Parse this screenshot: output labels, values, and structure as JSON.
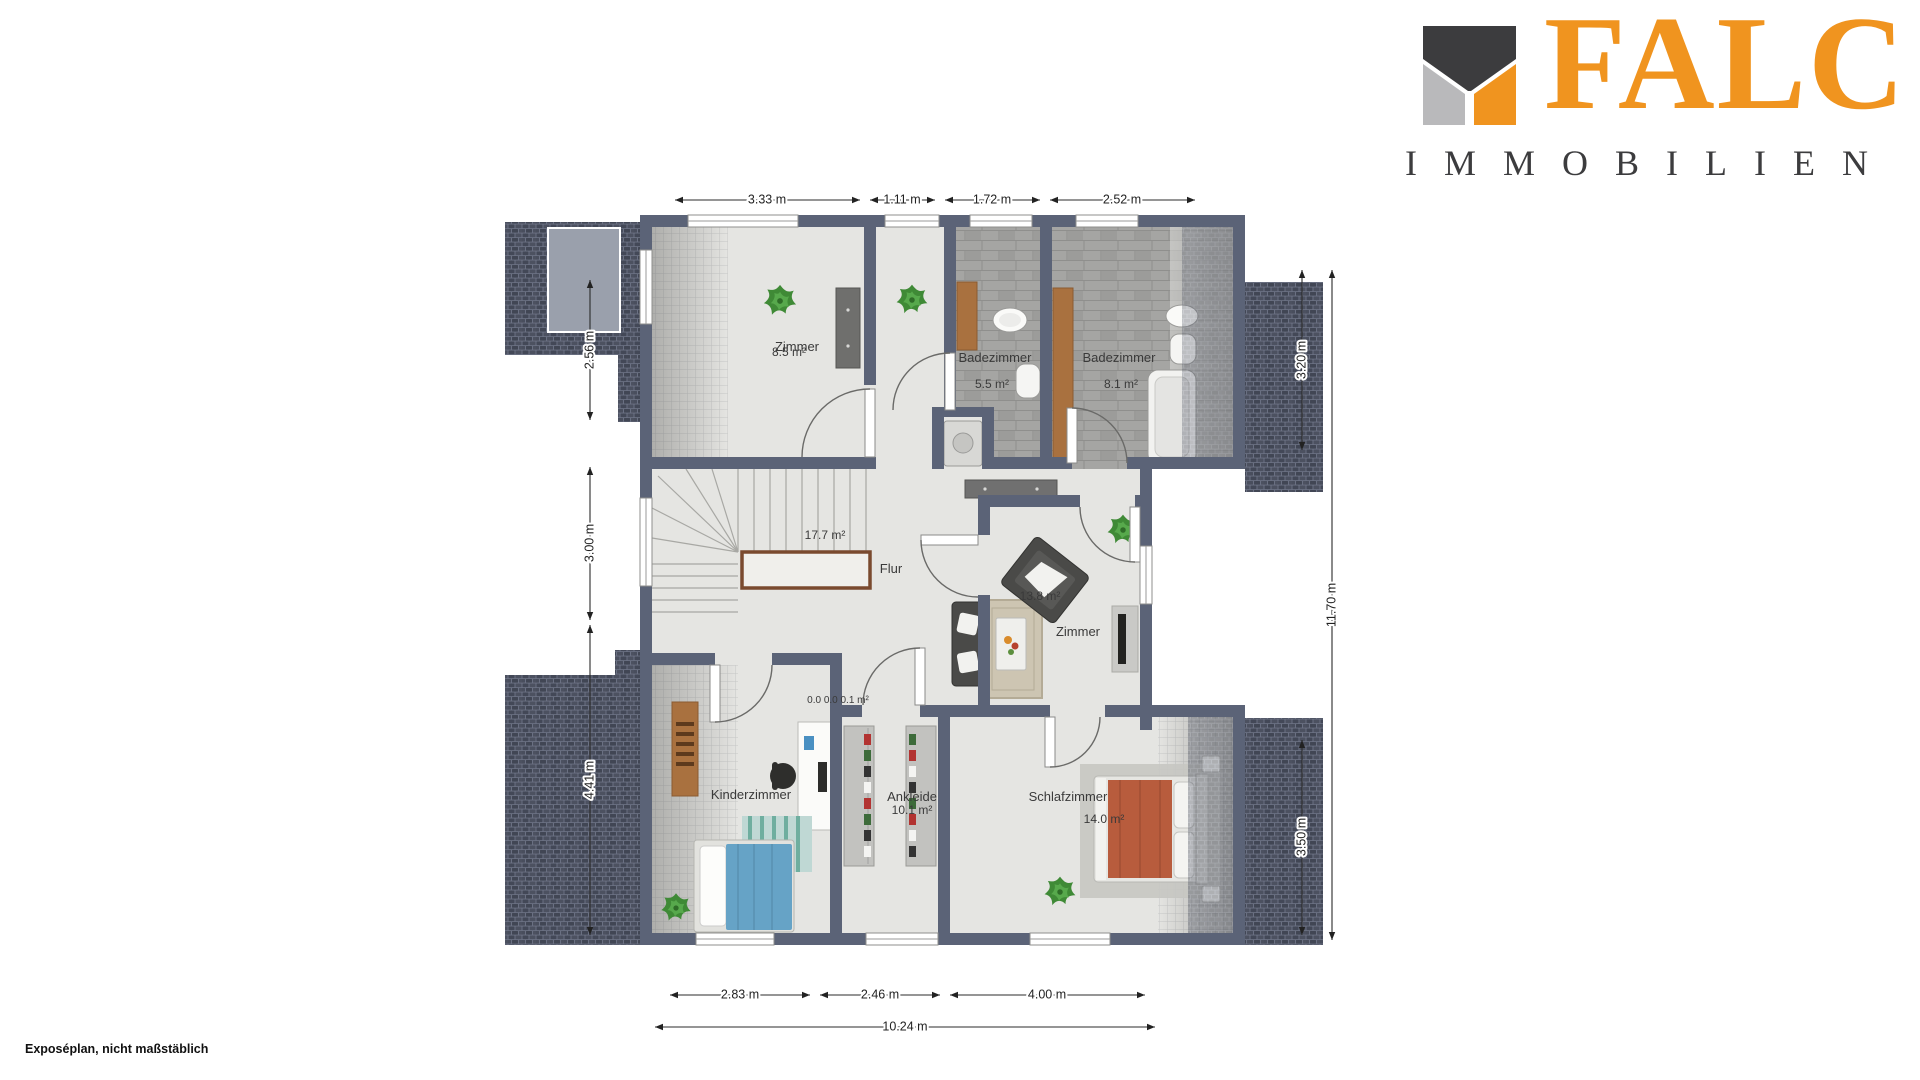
{
  "branding": {
    "logo_text": "FALC",
    "logo_subtext": "IMMOBILIEN"
  },
  "plan": {
    "rooms": {
      "zimmer_top": {
        "name": "Zimmer",
        "area": "8.5 m²"
      },
      "badezimmer_links": {
        "name": "Badezimmer",
        "area": "5.5 m²"
      },
      "badezimmer_rechts": {
        "name": "Badezimmer",
        "area": "8.1 m²"
      },
      "flur": {
        "name": "Flur",
        "area": "17.7 m²"
      },
      "zimmer_mitte": {
        "name": "Zimmer",
        "area": "13.8 m²"
      },
      "kinderzimmer": {
        "name": "Kinderzimmer"
      },
      "ankleide": {
        "name": "Ankleide",
        "area": "10.1 m²"
      },
      "schlafzimmer": {
        "name": "Schlafzimmer",
        "area": "14.0 m²"
      },
      "abstellflaechen": {
        "area": "0.0 0.0 0.1 m²"
      }
    },
    "dimensions": {
      "top": [
        "3.33 m",
        "1.11 m",
        "1.72 m",
        "2.52 m"
      ],
      "left": [
        "2.56 m",
        "3.00 m",
        "4.41 m"
      ],
      "right": [
        "3.20 m",
        "3.50 m"
      ],
      "right_total": "11.70 m",
      "bottom": [
        "2.83 m",
        "2.46 m",
        "4.00 m"
      ],
      "bottom_total": "10.24 m"
    }
  },
  "footer": {
    "note": "Exposéplan, nicht maßstäblich"
  },
  "colors": {
    "brand_orange": "#f0941f",
    "logo_dark": "#3c3c3e",
    "logo_gray": "#b9b9bb",
    "wall": "#5b6377",
    "floor": "#e5e5e2",
    "roof": "#4a4f5c",
    "tile": "#a5a5a3",
    "wood": "#a9713f",
    "bed_orange": "#b85c3d",
    "bed_blue": "#66a3c6"
  }
}
